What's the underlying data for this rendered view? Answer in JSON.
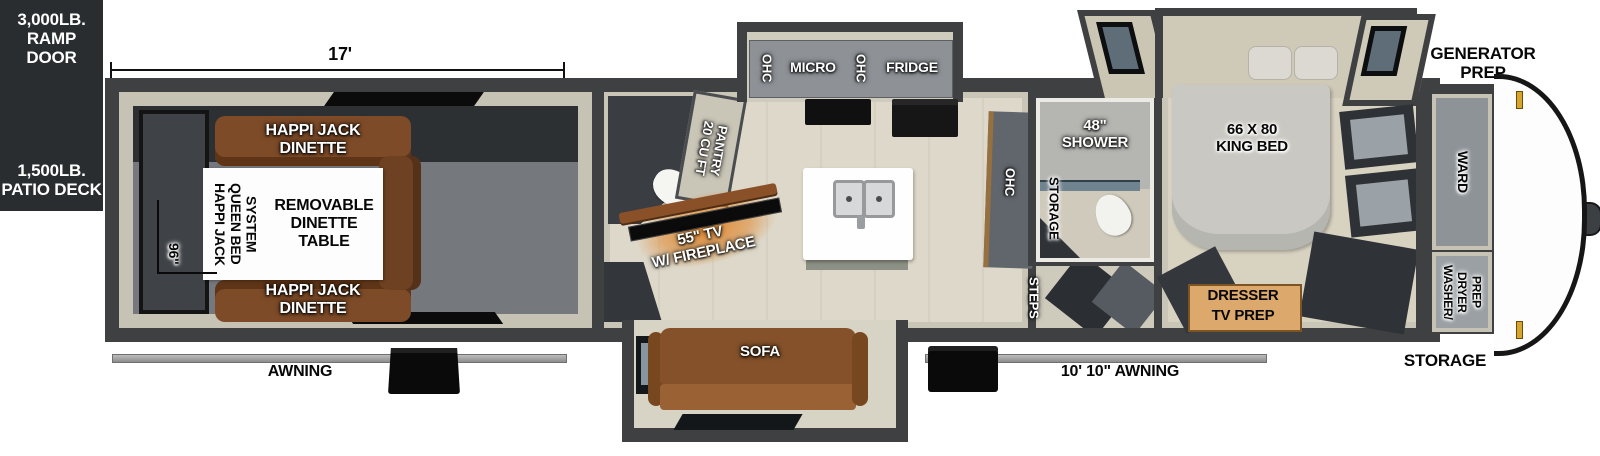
{
  "colors": {
    "wall": "#3f4041",
    "floor": "#d9d5c7",
    "dinette_brown": "#7d4b28",
    "sofa_brown": "#84512a",
    "fireplace_glow": "#e0862c",
    "exterior_block": "#2a2d2f",
    "awning_bar": "#a9a9a9",
    "gold_pin": "#d7a42c",
    "cabinet_gray": "#8e9297"
  },
  "exterior": {
    "ramp_door": "3,000LB.\nRAMP DOOR",
    "patio_deck": "1,500LB.\nPATIO DECK",
    "generator_prep": "GENERATOR\nPREP",
    "storage_rear": "STORAGE",
    "awning_left": "AWNING",
    "awning_right": "10' 10\" AWNING",
    "dim_garage_length": "17'",
    "dim_garage_width": "96\""
  },
  "garage": {
    "dinette_top": "HAPPI JACK\nDINETTE",
    "dinette_bottom": "HAPPI JACK\nDINETTE",
    "queen_bed_system": "HAPPI JACK\nQUEEN BED\nSYSTEM",
    "dinette_table": "REMOVABLE\nDINETTE\nTABLE"
  },
  "living": {
    "tv": "55\" TV\nW/ FIREPLACE",
    "pantry": "20 CU FT\nPANTRY",
    "sofa": "SOFA"
  },
  "kitchen": {
    "ohc_left": "OHC",
    "micro": "MICRO",
    "ohc_mid": "OHC",
    "fridge": "FRIDGE",
    "ohc_counter": "OHC"
  },
  "bath": {
    "shower": "48\"\nSHOWER",
    "storage": "STORAGE",
    "steps": "STEPS"
  },
  "bedroom": {
    "king_bed": "66 X 80\nKING BED",
    "dresser": "DRESSER",
    "tv_prep": "TV PREP"
  },
  "front": {
    "ward": "WARD",
    "washer_dryer_prep": "WASHER/\nDRYER\nPREP"
  }
}
